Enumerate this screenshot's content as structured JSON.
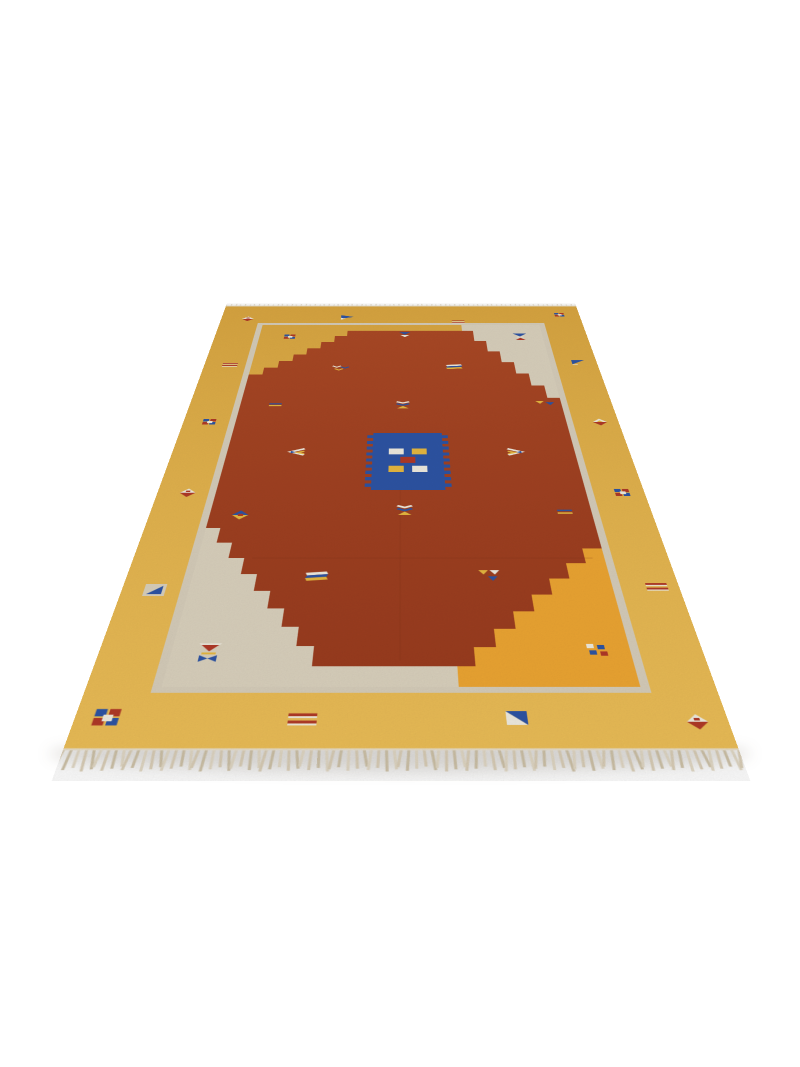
{
  "description": "Product photograph of a handwoven kilim flatweave rug lying on a white floor, viewed at an angle. Yellow outer border with small geometric motifs, cream inner guard line, stepped rust-red central field with scattered triangle, diamond, stripe and square motifs, a blue comb-edged central medallion, stepped corner panels in cream and golden orange, and beige tassel fringe on the near and far ends.",
  "scene": {
    "width": 800,
    "height": 1067,
    "background": "#ffffff"
  },
  "rug": {
    "flat_width": 676,
    "flat_height": 1266,
    "svg_height": 1325,
    "pad_top": 15,
    "transform": {
      "perspective": 1000,
      "rotate_x_deg": 47.36,
      "left": 63,
      "top": -531,
      "origin": "338px 1281px"
    },
    "palette": {
      "yellow_top": "#DBA741",
      "yellow_bottom": "#EDBF58",
      "gold": "#EFA733",
      "cream": "#DCD3BF",
      "line": "#D8CFBC",
      "red_top": "#AD4A26",
      "red_bottom": "#9C3D1F",
      "blue": "#2E55A6",
      "motif_red": "#B23A28",
      "motif_white": "#F2EEE2",
      "motif_yellow": "#E9BA41",
      "seam": "#7A2F15",
      "binding": "#E9E2D2",
      "fringe": [
        "#D8CCB4",
        "#CCBFA4",
        "#E0D6C2"
      ],
      "fringe_top": "#E7E0D1"
    },
    "border_line": {
      "x": 76,
      "y": 95,
      "w": 524,
      "h": 1076,
      "stroke_w": 10
    },
    "regions": {
      "cream_tr": "450,98 595,98 595,480 450,140",
      "cream_bl": "81,834 150,834 400,1126 400,1170 81,1170",
      "gold_br": "595,885 545,885 400,1126 400,1170 595,1170"
    },
    "red_field": "240,130 470,130 470,179 491,179 491,228 512,228 512,277 533,277 533,326 554,326 554,375 575,375 575,424 595,424 595,885 570,885 570,920 545,920 545,955 520,955 520,990 495,990 495,1025 470,1025 470,1060 445,1060 445,1095 420,1095 420,1130 240,1130 240,1093 220,1093 220,1056 200,1056 200,1019 180,1019 180,982 160,982 160,945 140,945 140,908 120,908 120,871 100,871 100,834 81,834 81,330 104,330 104,301 127,301 127,272 150,272 150,243 172,243 172,214 195,214 195,185 218,185 218,156 240,156",
    "seams": {
      "h_y": 908,
      "h_x1": 150,
      "h_x2": 580,
      "v_x": 337,
      "v_y1": 690,
      "v_y2": 1120
    },
    "medallion": {
      "x": 296,
      "y": 552,
      "w": 104,
      "h": 179,
      "teeth": {
        "count": 9,
        "w": 9,
        "h": 10,
        "step": 19,
        "offset": 8
      },
      "squares": [
        {
          "x": 320,
          "y": 604,
          "w": 22,
          "h": 19,
          "c": "motif_white"
        },
        {
          "x": 354,
          "y": 604,
          "w": 22,
          "h": 19,
          "c": "motif_yellow"
        },
        {
          "x": 320,
          "y": 659,
          "w": 22,
          "h": 19,
          "c": "motif_yellow"
        },
        {
          "x": 354,
          "y": 659,
          "w": 22,
          "h": 19,
          "c": "motif_white"
        },
        {
          "x": 337,
          "y": 631,
          "w": 22,
          "h": 19,
          "c": "motif_red"
        }
      ]
    },
    "motifs": [
      {
        "type": "diamond_wr",
        "x": 50,
        "y": 69
      },
      {
        "type": "tri_flag",
        "x": 238,
        "y": 59
      },
      {
        "type": "stripes2_red",
        "x": 445,
        "y": 85,
        "s": 0.9
      },
      {
        "type": "squares4",
        "x": 639,
        "y": 48,
        "s": 0.9
      },
      {
        "type": "stripes2_red",
        "x": 44,
        "y": 289
      },
      {
        "type": "tri_outline",
        "x": 644,
        "y": 276
      },
      {
        "type": "squares4",
        "x": 41,
        "y": 514
      },
      {
        "type": "diamond_wr",
        "x": 42,
        "y": 739
      },
      {
        "type": "diamond_wry",
        "x": 647,
        "y": 514
      },
      {
        "type": "stripes2_red",
        "x": 649,
        "y": 974
      },
      {
        "type": "squares4",
        "x": 646,
        "y": 739
      },
      {
        "type": "tri_square",
        "x": 40,
        "y": 980
      },
      {
        "type": "squares4",
        "x": 34,
        "y": 1217,
        "s": 1.3
      },
      {
        "type": "stripes2_red",
        "x": 236,
        "y": 1220,
        "s": 1.15
      },
      {
        "type": "tri_split",
        "x": 458,
        "y": 1217
      },
      {
        "type": "diamond_wr",
        "x": 644,
        "y": 1223
      },
      {
        "type": "hourglass_rb",
        "x": 123,
        "y": 1106
      },
      {
        "type": "dots4",
        "x": 558,
        "y": 1100
      },
      {
        "type": "hourglass_br",
        "x": 554,
        "y": 160
      },
      {
        "type": "squares4",
        "x": 137,
        "y": 160
      },
      {
        "type": "tri_down_bw",
        "x": 345,
        "y": 150
      },
      {
        "type": "chevrons3",
        "x": 234,
        "y": 302
      },
      {
        "type": "arrow_stack",
        "x": 430,
        "y": 298
      },
      {
        "type": "stripes2_by",
        "x": 137,
        "y": 451
      },
      {
        "type": "tri_pair",
        "x": 569,
        "y": 444
      },
      {
        "type": "hourglass_wby",
        "x": 341,
        "y": 451
      },
      {
        "type": "wing_l",
        "x": 184,
        "y": 615
      },
      {
        "type": "wing_r",
        "x": 507,
        "y": 615
      },
      {
        "type": "diamond_by",
        "x": 122,
        "y": 800
      },
      {
        "type": "stripes2_by",
        "x": 559,
        "y": 792
      },
      {
        "type": "hourglass_wby",
        "x": 343,
        "y": 787
      },
      {
        "type": "arrow_stack",
        "x": 235,
        "y": 951
      },
      {
        "type": "tri_trio",
        "x": 448,
        "y": 947
      }
    ],
    "fringe": {
      "bottom": {
        "spacing": 7.5,
        "len_base": 24,
        "len_var": 8,
        "width": 3
      },
      "top": {
        "spacing": 9,
        "len_base": 8,
        "len_var": 5,
        "width": 2.4
      }
    },
    "shadow": {
      "left": 48,
      "top": 737,
      "width": 704,
      "height": 34,
      "blur": 7,
      "color": "rgba(70,58,40,0.16)"
    }
  }
}
